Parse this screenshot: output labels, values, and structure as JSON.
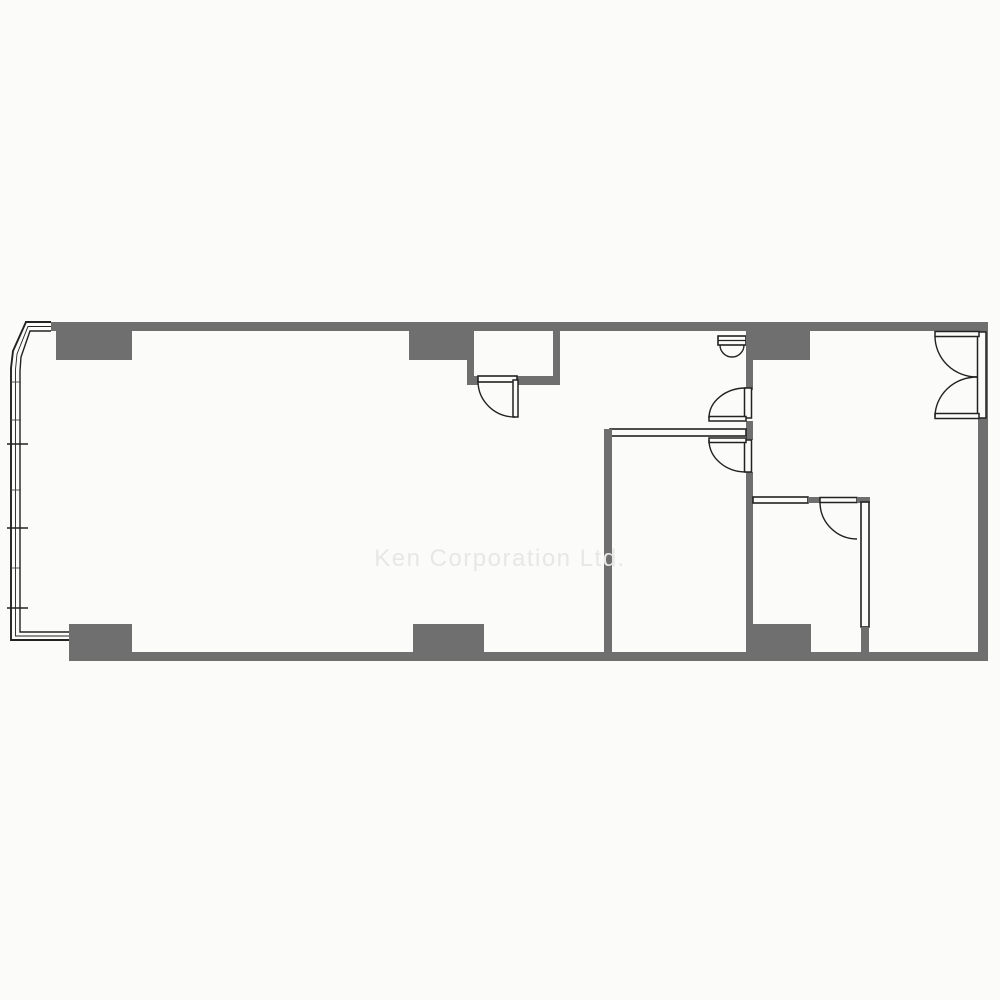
{
  "watermark": {
    "text": "Ken Corporation Ltd."
  },
  "palette": {
    "background": "#fbfbf9",
    "wall": "#6f6f6f",
    "line": "#222222",
    "watermark": "#e7e7e4"
  },
  "plan": {
    "kind": "office-floor-plan",
    "features": [
      "curved-bay-window-wall-left",
      "entrance-alcove-with-door-top-center",
      "meter-box-double-door-top",
      "double-entry-door-right-wall",
      "hallway-with-two-hinged-doors",
      "center-room",
      "small-room-bottom-right",
      "structural-columns"
    ]
  }
}
